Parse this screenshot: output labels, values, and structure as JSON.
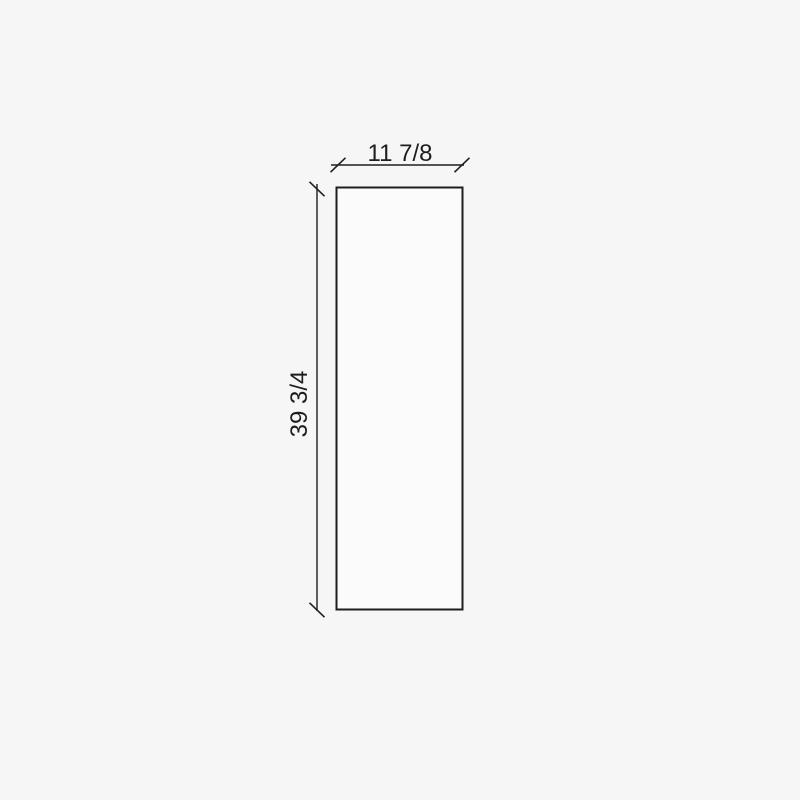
{
  "diagram": {
    "width_label": "11 7/8",
    "height_label": "39 3/4",
    "colors": {
      "background": "#f6f6f6",
      "panel_fill": "#fbfbfb",
      "line": "#1e1e1e",
      "text": "#1e1e1e"
    }
  }
}
